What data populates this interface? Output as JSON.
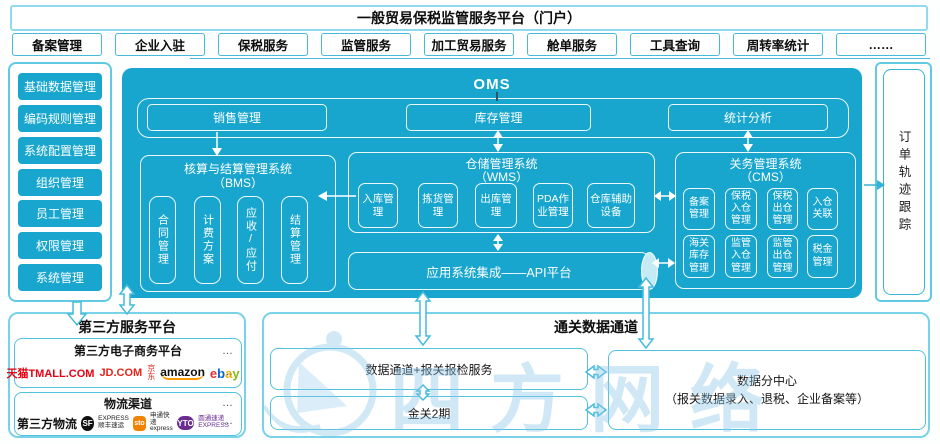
{
  "header": {
    "title": "一般贸易保税监管服务平台（门户）"
  },
  "menu": {
    "items": [
      "备案管理",
      "企业入驻",
      "保税服务",
      "监管服务",
      "加工贸易服务",
      "舱单服务",
      "工具查询",
      "周转率统计",
      "……"
    ]
  },
  "sidebar": {
    "items": [
      "基础数据管理",
      "编码规则管理",
      "系统配置管理",
      "组织管理",
      "员工管理",
      "权限管理",
      "系统管理"
    ]
  },
  "oms": {
    "title": "OMS",
    "top_modules": [
      "销售管理",
      "库存管理",
      "统计分析"
    ],
    "bms": {
      "title_line1": "核算与结算管理系统",
      "title_line2": "（BMS）",
      "items": [
        "合同管理",
        "计费方案",
        "应收/应付",
        "结算管理"
      ]
    },
    "wms": {
      "title_line1": "仓储管理系统",
      "title_line2": "（WMS）",
      "items": [
        "入库管理",
        "拣货管理",
        "出库管理",
        "PDA作业管理",
        "仓库辅助设备"
      ]
    },
    "cms": {
      "title_line1": "关务管理系统",
      "title_line2": "（CMS）",
      "row1": [
        "备案管理",
        "保税入仓管理",
        "保税出仓管理",
        "入仓关联"
      ],
      "row2": [
        "海关库存管理",
        "监管入仓管理",
        "监管出仓管理",
        "税金管理"
      ]
    },
    "api_bar": "应用系统集成——API平台"
  },
  "order_tracking": {
    "label": "订单轨迹跟踪"
  },
  "third_party": {
    "title": "第三方服务平台",
    "more": "…",
    "ecommerce": {
      "title": "第三方电子商务平台",
      "tmall_cn": "天猫",
      "tmall_en": "TMALL.COM",
      "jd": "JD.COM",
      "jd_cn": "京东",
      "amazon": "amazon",
      "ebay_e": "e",
      "ebay_b": "b",
      "ebay_a": "a",
      "ebay_y": "y"
    },
    "logistics": {
      "title": "物流渠道",
      "label": "第三方物流",
      "sf_badge": "SF",
      "sf_line1": "EXPRESS",
      "sf_line2": "顺丰速运",
      "sto_badge": "sto",
      "sto_line1": "申通快递",
      "sto_line2": "express",
      "yto_badge": "YTO",
      "yto_line1": "圆通速递",
      "yto_line2": "EXPRESS"
    }
  },
  "customs": {
    "title": "通关数据通道",
    "box1": "数据通道+报关报检服务",
    "box2": "金关2期",
    "datacenter_line1": "数据分中心",
    "datacenter_line2": "（报关数据录入、退税、企业备案等）"
  },
  "watermark": "四方网络",
  "colors": {
    "accent_cyan": "#18a6cf",
    "border_cyan": "#62c9e2",
    "arrow_cyan": "#45bcdd",
    "tmall_red": "#e60012",
    "jd_red": "#e1251b",
    "amazon_orange": "#ff9900",
    "ebay": [
      "#e53238",
      "#0064d2",
      "#f5af02",
      "#86b817"
    ],
    "sto_orange": "#f08300",
    "yto_purple": "#6a2c91",
    "watermark_blue": "#8ec7e8"
  }
}
